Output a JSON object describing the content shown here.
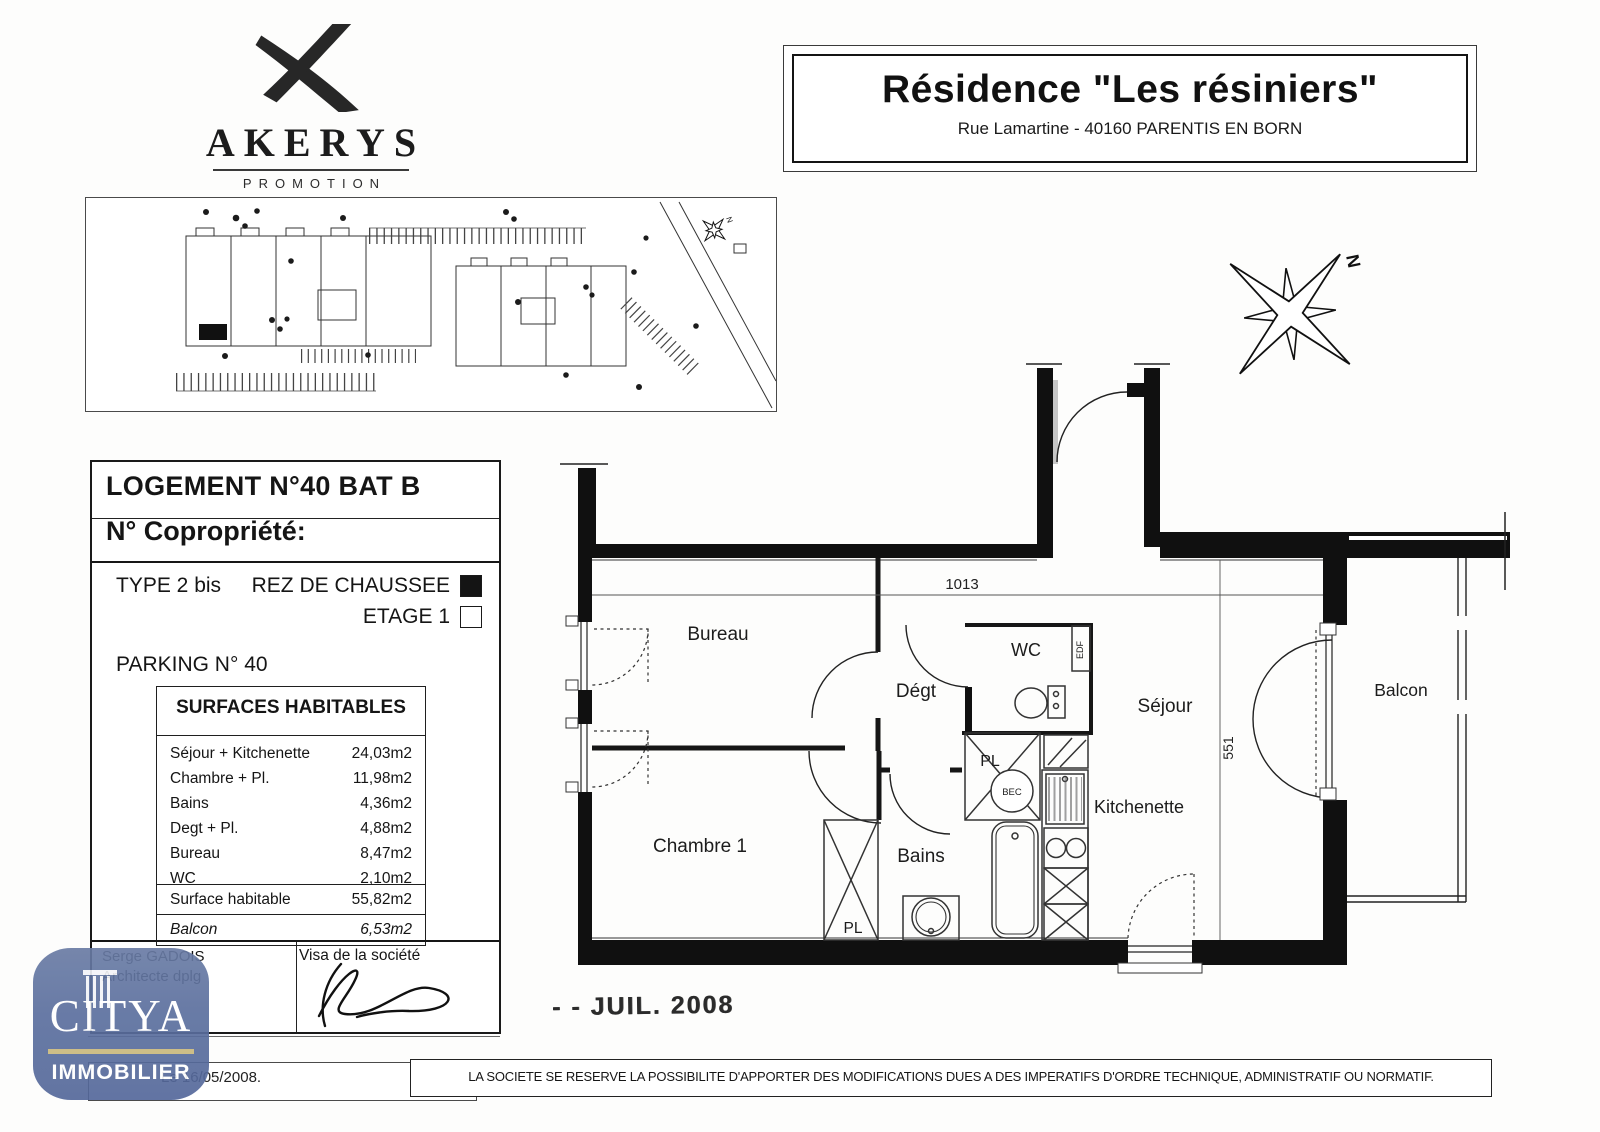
{
  "branding": {
    "name": "AKERYS",
    "tagline": "PROMOTION"
  },
  "title_block": {
    "title": "Résidence \"Les résiniers\"",
    "address": "Rue Lamartine - 40160 PARENTIS EN BORN"
  },
  "unit_info": {
    "logement": "LOGEMENT N°40  BAT B",
    "copropriete": "N° Copropriété:",
    "type": "TYPE 2 bis",
    "floors": [
      {
        "label": "REZ DE CHAUSSEE",
        "selected": true
      },
      {
        "label": "ETAGE 1",
        "selected": false
      }
    ],
    "parking": "PARKING N° 40"
  },
  "surfaces": {
    "header": "SURFACES HABITABLES",
    "rows": [
      {
        "label": "Séjour + Kitchenette",
        "value": "24,03m2"
      },
      {
        "label": "Chambre + Pl.",
        "value": "11,98m2"
      },
      {
        "label": "Bains",
        "value": "4,36m2"
      },
      {
        "label": "Degt + Pl.",
        "value": "4,88m2"
      },
      {
        "label": "Bureau",
        "value": "8,47m2"
      },
      {
        "label": "WC",
        "value": "2,10m2"
      }
    ],
    "total": {
      "label": "Surface habitable",
      "value": "55,82m2"
    },
    "balcon": {
      "label": "Balcon",
      "value": "6,53m2"
    }
  },
  "signatures": {
    "architect_name": "Serge GADOIS",
    "architect_title": "Architecte dplg",
    "visa_label": "Visa de la société"
  },
  "footer": {
    "date": "Le 16/05/2008.",
    "disclaimer": "LA SOCIETE SE RESERVE LA POSSIBILITE D'APPORTER DES MODIFICATIONS DUES A DES IMPERATIFS D'ORDRE TECHNIQUE, ADMINISTRATIF OU NORMATIF."
  },
  "stamp": "- - JUIL. 2008",
  "citya": {
    "name": "CITYA",
    "subtitle": "IMMOBILIER"
  },
  "compass": {
    "north": "N"
  },
  "site_plan": {
    "north": "N"
  },
  "floor_plan": {
    "labels": {
      "bureau": "Bureau",
      "degt": "Dégt",
      "wc": "WC",
      "sejour": "Séjour",
      "balcon": "Balcon",
      "chambre": "Chambre 1",
      "bains": "Bains",
      "kitchenette": "Kitchenette",
      "pl_center": "PL",
      "pl_bains": "PL",
      "edf": "EDF",
      "bec": "BEC"
    },
    "dimensions": {
      "width": "1013",
      "height": "551"
    }
  },
  "colors": {
    "wall": "#111111",
    "citya_blue": "#5b6f9e",
    "citya_gold": "#c9b87c"
  }
}
